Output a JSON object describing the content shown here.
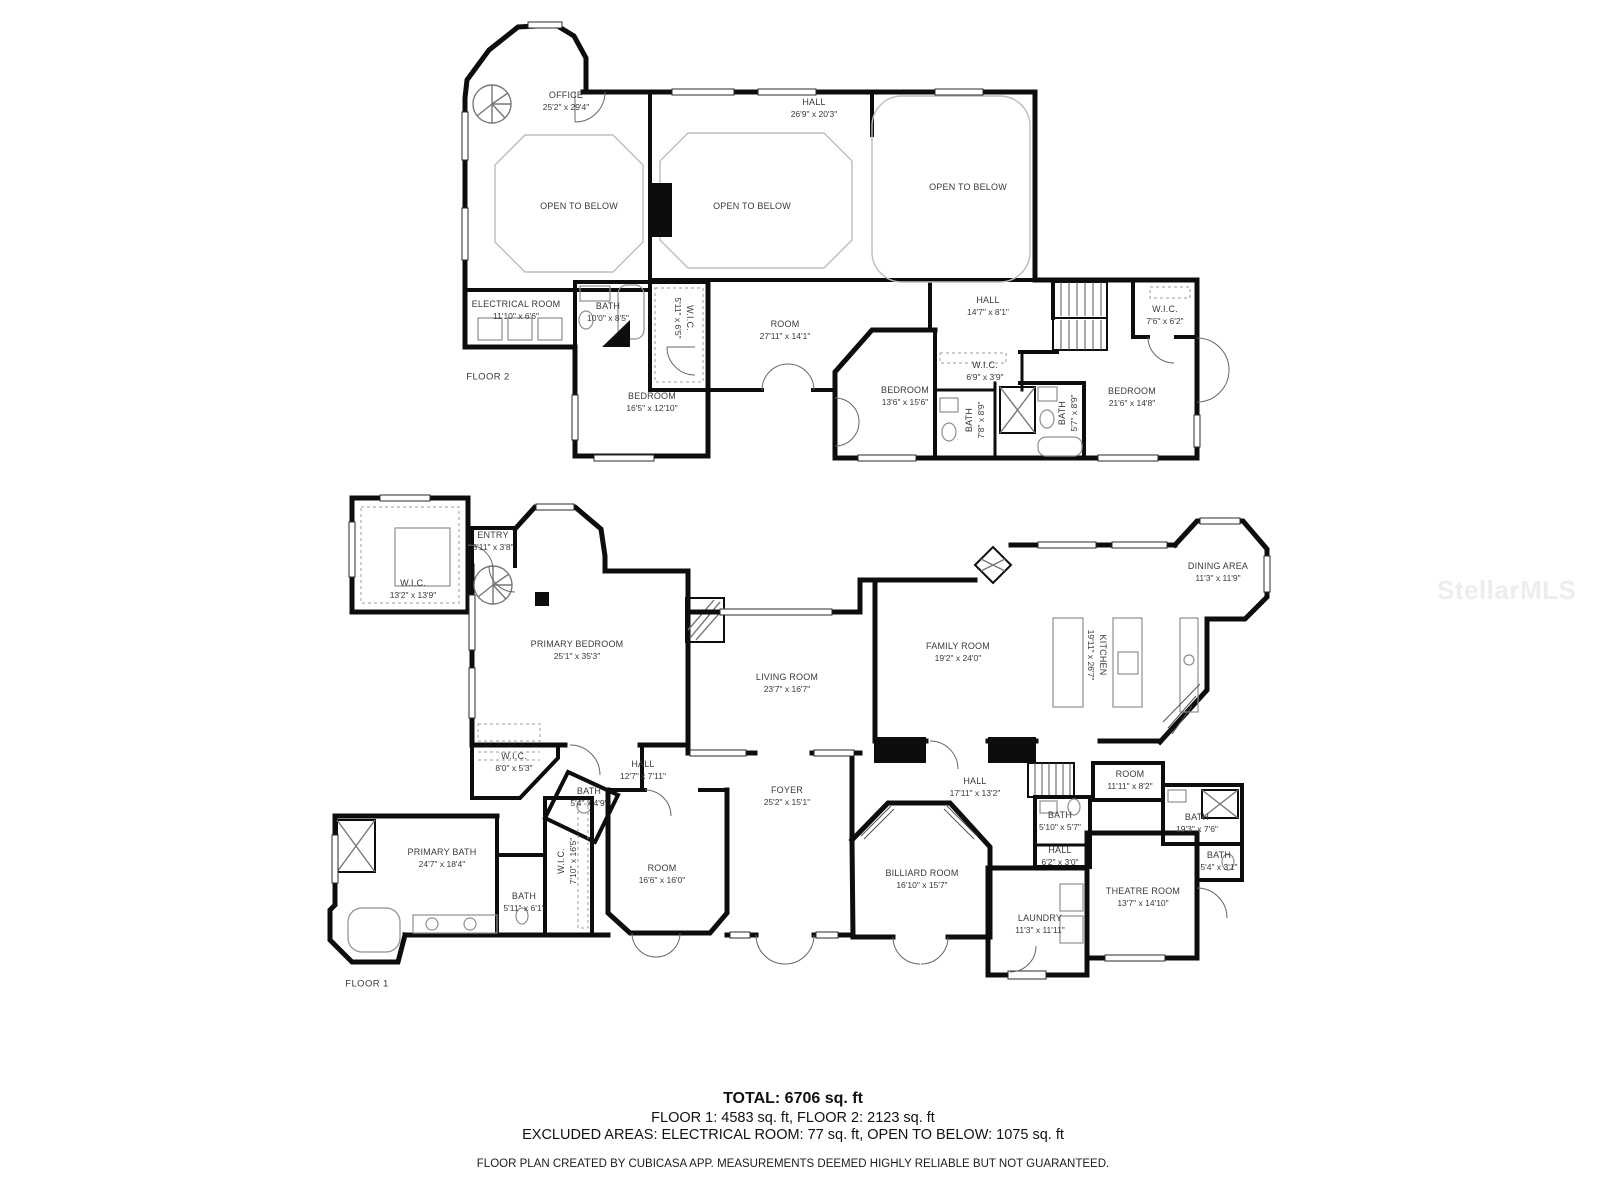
{
  "watermark": "StellarMLS",
  "floor2": {
    "label": "FLOOR 2",
    "rooms": [
      {
        "name": "OFFICE",
        "dims": "25'2\" x 29'4\""
      },
      {
        "name": "HALL",
        "dims": "26'9\" x 20'3\""
      },
      {
        "name": "OPEN TO BELOW",
        "dims": ""
      },
      {
        "name": "OPEN TO BELOW",
        "dims": ""
      },
      {
        "name": "OPEN TO BELOW",
        "dims": ""
      },
      {
        "name": "ELECTRICAL ROOM",
        "dims": "11'10\" x 6'6\""
      },
      {
        "name": "BATH",
        "dims": "10'0\" x 8'5\""
      },
      {
        "name": "W.I.C.",
        "dims": "5'11\" x 6'5\""
      },
      {
        "name": "ROOM",
        "dims": "27'11\" x 14'1\""
      },
      {
        "name": "HALL",
        "dims": "14'7\" x 8'1\""
      },
      {
        "name": "W.I.C.",
        "dims": "7'6\" x 6'2\""
      },
      {
        "name": "BEDROOM",
        "dims": "16'5\" x 12'10\""
      },
      {
        "name": "BEDROOM",
        "dims": "13'6\" x 15'6\""
      },
      {
        "name": "W.I.C.",
        "dims": "6'9\" x 3'9\""
      },
      {
        "name": "BATH",
        "dims": "7'8\" x 8'9\""
      },
      {
        "name": "BATH",
        "dims": "5'7\" x 8'9\""
      },
      {
        "name": "BEDROOM",
        "dims": "21'6\" x 14'8\""
      }
    ]
  },
  "floor1": {
    "label": "FLOOR 1",
    "rooms": [
      {
        "name": "W.I.C.",
        "dims": "13'2\" x 13'9\""
      },
      {
        "name": "ENTRY",
        "dims": "3'11\" x 3'8\""
      },
      {
        "name": "PRIMARY BEDROOM",
        "dims": "25'1\" x 35'3\""
      },
      {
        "name": "LIVING ROOM",
        "dims": "23'7\" x 16'7\""
      },
      {
        "name": "FAMILY ROOM",
        "dims": "19'2\" x 24'0\""
      },
      {
        "name": "KITCHEN",
        "dims": "19'11\" x 26'7\""
      },
      {
        "name": "DINING AREA",
        "dims": "11'3\" x 11'9\""
      },
      {
        "name": "W.I.C.",
        "dims": "8'0\" x 5'3\""
      },
      {
        "name": "HALL",
        "dims": "12'7\" x 7'11\""
      },
      {
        "name": "BATH",
        "dims": "5'4\" x 4'9\""
      },
      {
        "name": "PRIMARY BATH",
        "dims": "24'7\" x 18'4\""
      },
      {
        "name": "W.I.C.",
        "dims": "7'10\" x 16'5\""
      },
      {
        "name": "BATH",
        "dims": "5'11\" x 6'1\""
      },
      {
        "name": "ROOM",
        "dims": "16'6\" x 16'0\""
      },
      {
        "name": "FOYER",
        "dims": "25'2\" x 15'1\""
      },
      {
        "name": "HALL",
        "dims": "17'11\" x 13'2\""
      },
      {
        "name": "BATH",
        "dims": "5'10\" x 5'7\""
      },
      {
        "name": "HALL",
        "dims": "6'2\" x 3'0\""
      },
      {
        "name": "BILLIARD ROOM",
        "dims": "16'10\" x 15'7\""
      },
      {
        "name": "LAUNDRY",
        "dims": "11'3\" x 11'11\""
      },
      {
        "name": "THEATRE ROOM",
        "dims": "13'7\" x 14'10\""
      },
      {
        "name": "ROOM",
        "dims": "11'11\" x 8'2\""
      },
      {
        "name": "BATH",
        "dims": "19'3\" x 7'6\""
      },
      {
        "name": "BATH",
        "dims": "5'4\" x 3'1\""
      }
    ]
  },
  "summary": {
    "total": "TOTAL: 6706 sq. ft",
    "floors": "FLOOR 1: 4583 sq. ft, FLOOR 2: 2123 sq. ft",
    "excluded": "EXCLUDED AREAS: ELECTRICAL ROOM: 77 sq. ft, OPEN TO BELOW: 1075 sq. ft",
    "disclaimer": "FLOOR PLAN CREATED BY CUBICASA APP. MEASUREMENTS DEEMED HIGHLY RELIABLE BUT NOT GUARANTEED."
  }
}
